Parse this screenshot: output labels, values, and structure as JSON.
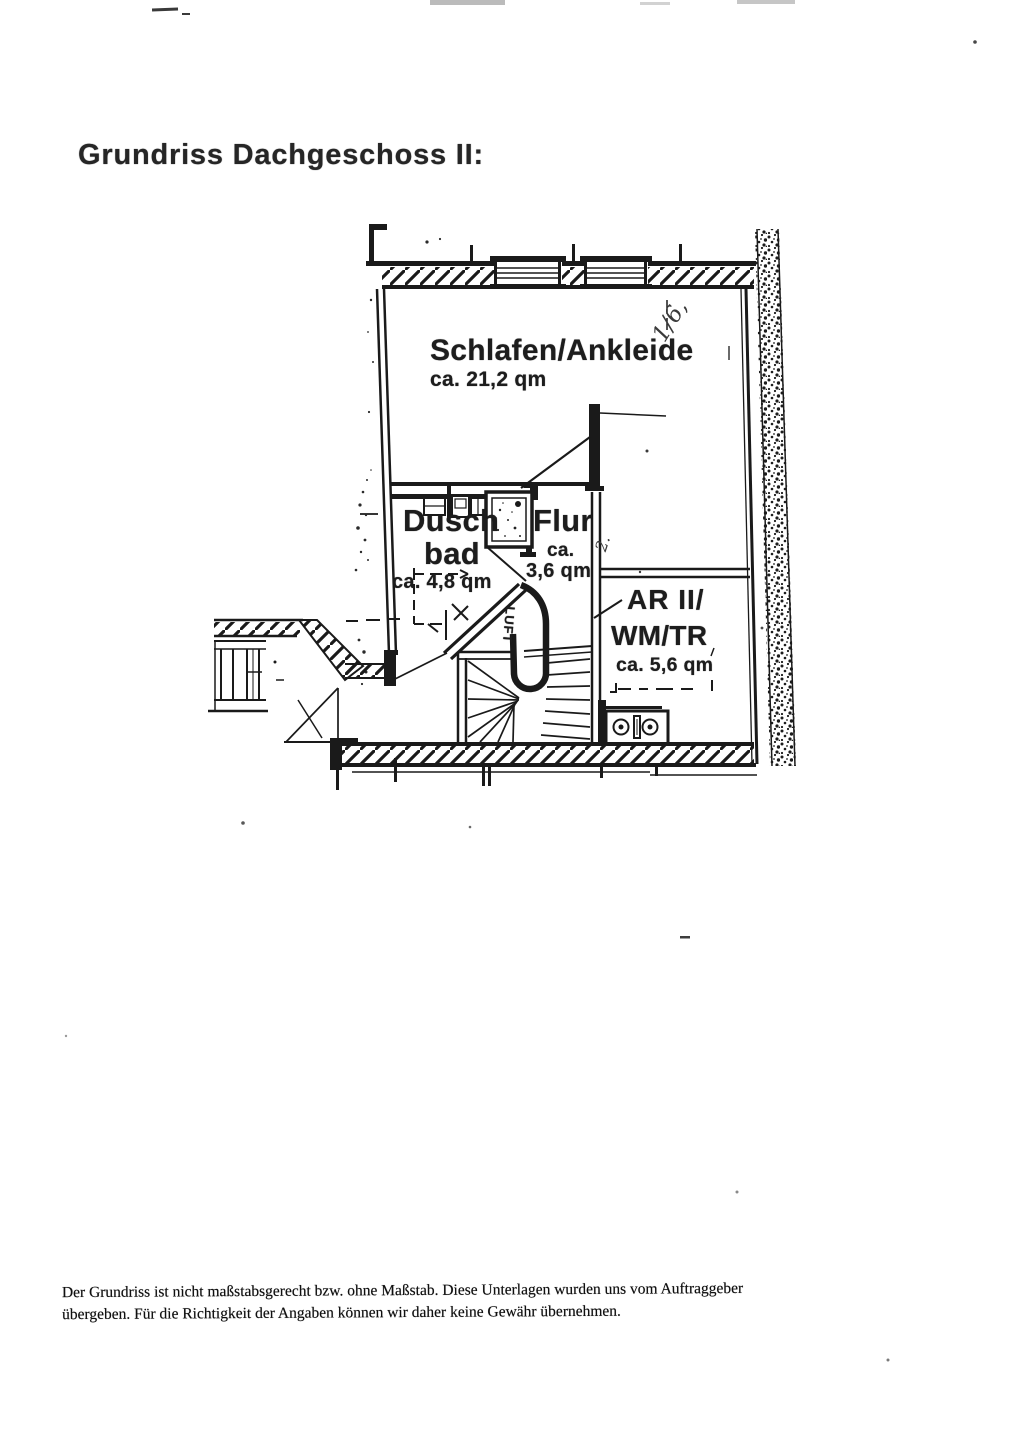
{
  "document": {
    "title": "Grundriss Dachgeschoss II:",
    "footer": {
      "line1": "Der Grundriss ist nicht maßstabsgerecht bzw. ohne Maßstab. Diese Unterlagen wurden uns vom Auftraggeber",
      "line2": "übergeben. Für die Richtigkeit der Angaben können wir daher keine Gewähr übernehmen."
    }
  },
  "floor_plan": {
    "floor_name": "Dachgeschoss II",
    "rooms": [
      {
        "id": "schlafen-ankleide",
        "name": "Schlafen/Ankleide",
        "area": "ca. 21,2 qm"
      },
      {
        "id": "duschbad",
        "name_line1": "Dusch",
        "name_line2": "bad",
        "area": "ca. 4,8 qm"
      },
      {
        "id": "flur",
        "name": "Flur",
        "area_line1": "ca.",
        "area_line2": "3,6 qm"
      },
      {
        "id": "abstellraum-wm-tr",
        "name_line1": "AR II/",
        "name_line2": "WM/TR",
        "area": "ca. 5,6 qm"
      }
    ],
    "stairwell_label": "LUFT",
    "handwritten_marks": [
      "1/6,",
      "2."
    ],
    "ink_color": "#1a1a1a",
    "paper_color": "#ffffff"
  }
}
